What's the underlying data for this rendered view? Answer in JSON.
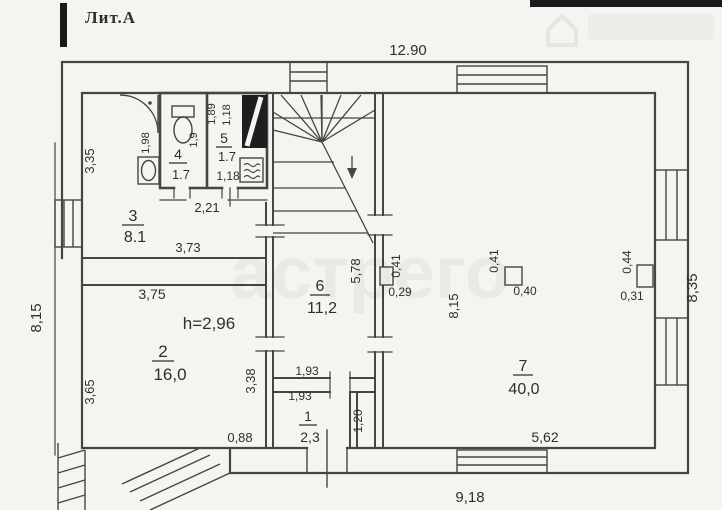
{
  "colors": {
    "ink": "#454545",
    "paper": "#f5f4f1",
    "scan_bar": "#1a1a1a"
  },
  "plan": {
    "litera": "Лит.А",
    "watermark": "астрего",
    "overall": {
      "top": "12.90",
      "bottom": "9,18",
      "left": "8,15",
      "right": "8,35"
    },
    "rooms": {
      "r1": {
        "num": "1",
        "area": "2,3",
        "dim_w1": "1,93",
        "dim_w2": "1,93",
        "dim_h": "1,20"
      },
      "r2": {
        "num": "2",
        "area": "16,0",
        "ceiling": "h=2,96",
        "dim_top": "3,75",
        "dim_left": "3,65",
        "dim_right": "3,38",
        "dim_bottom": "0,88"
      },
      "r3": {
        "num": "3",
        "area": "8.1",
        "dim_left": "3,35",
        "dim_bottom": "3,73",
        "dim_top": "2,21",
        "dim_door": "1,98"
      },
      "r4": {
        "num": "4",
        "area": "1.7",
        "dim_w": "1,9"
      },
      "r5": {
        "num": "5",
        "area": "1.7",
        "dim_b": "1,18",
        "dim_w1": "1,89",
        "dim_w2": "1,18"
      },
      "r6": {
        "num": "6",
        "area": "11,2",
        "dim_left": "5,78"
      },
      "r7": {
        "num": "7",
        "area": "40,0",
        "dim_left": "8,15",
        "dim_bottom": "5,62"
      }
    },
    "pillars": {
      "p1": {
        "w": "0,41",
        "d": "0,29"
      },
      "p2": {
        "w": "0,41",
        "d": "0,40"
      },
      "p3": {
        "w": "0,44",
        "d": "0,31"
      }
    }
  }
}
